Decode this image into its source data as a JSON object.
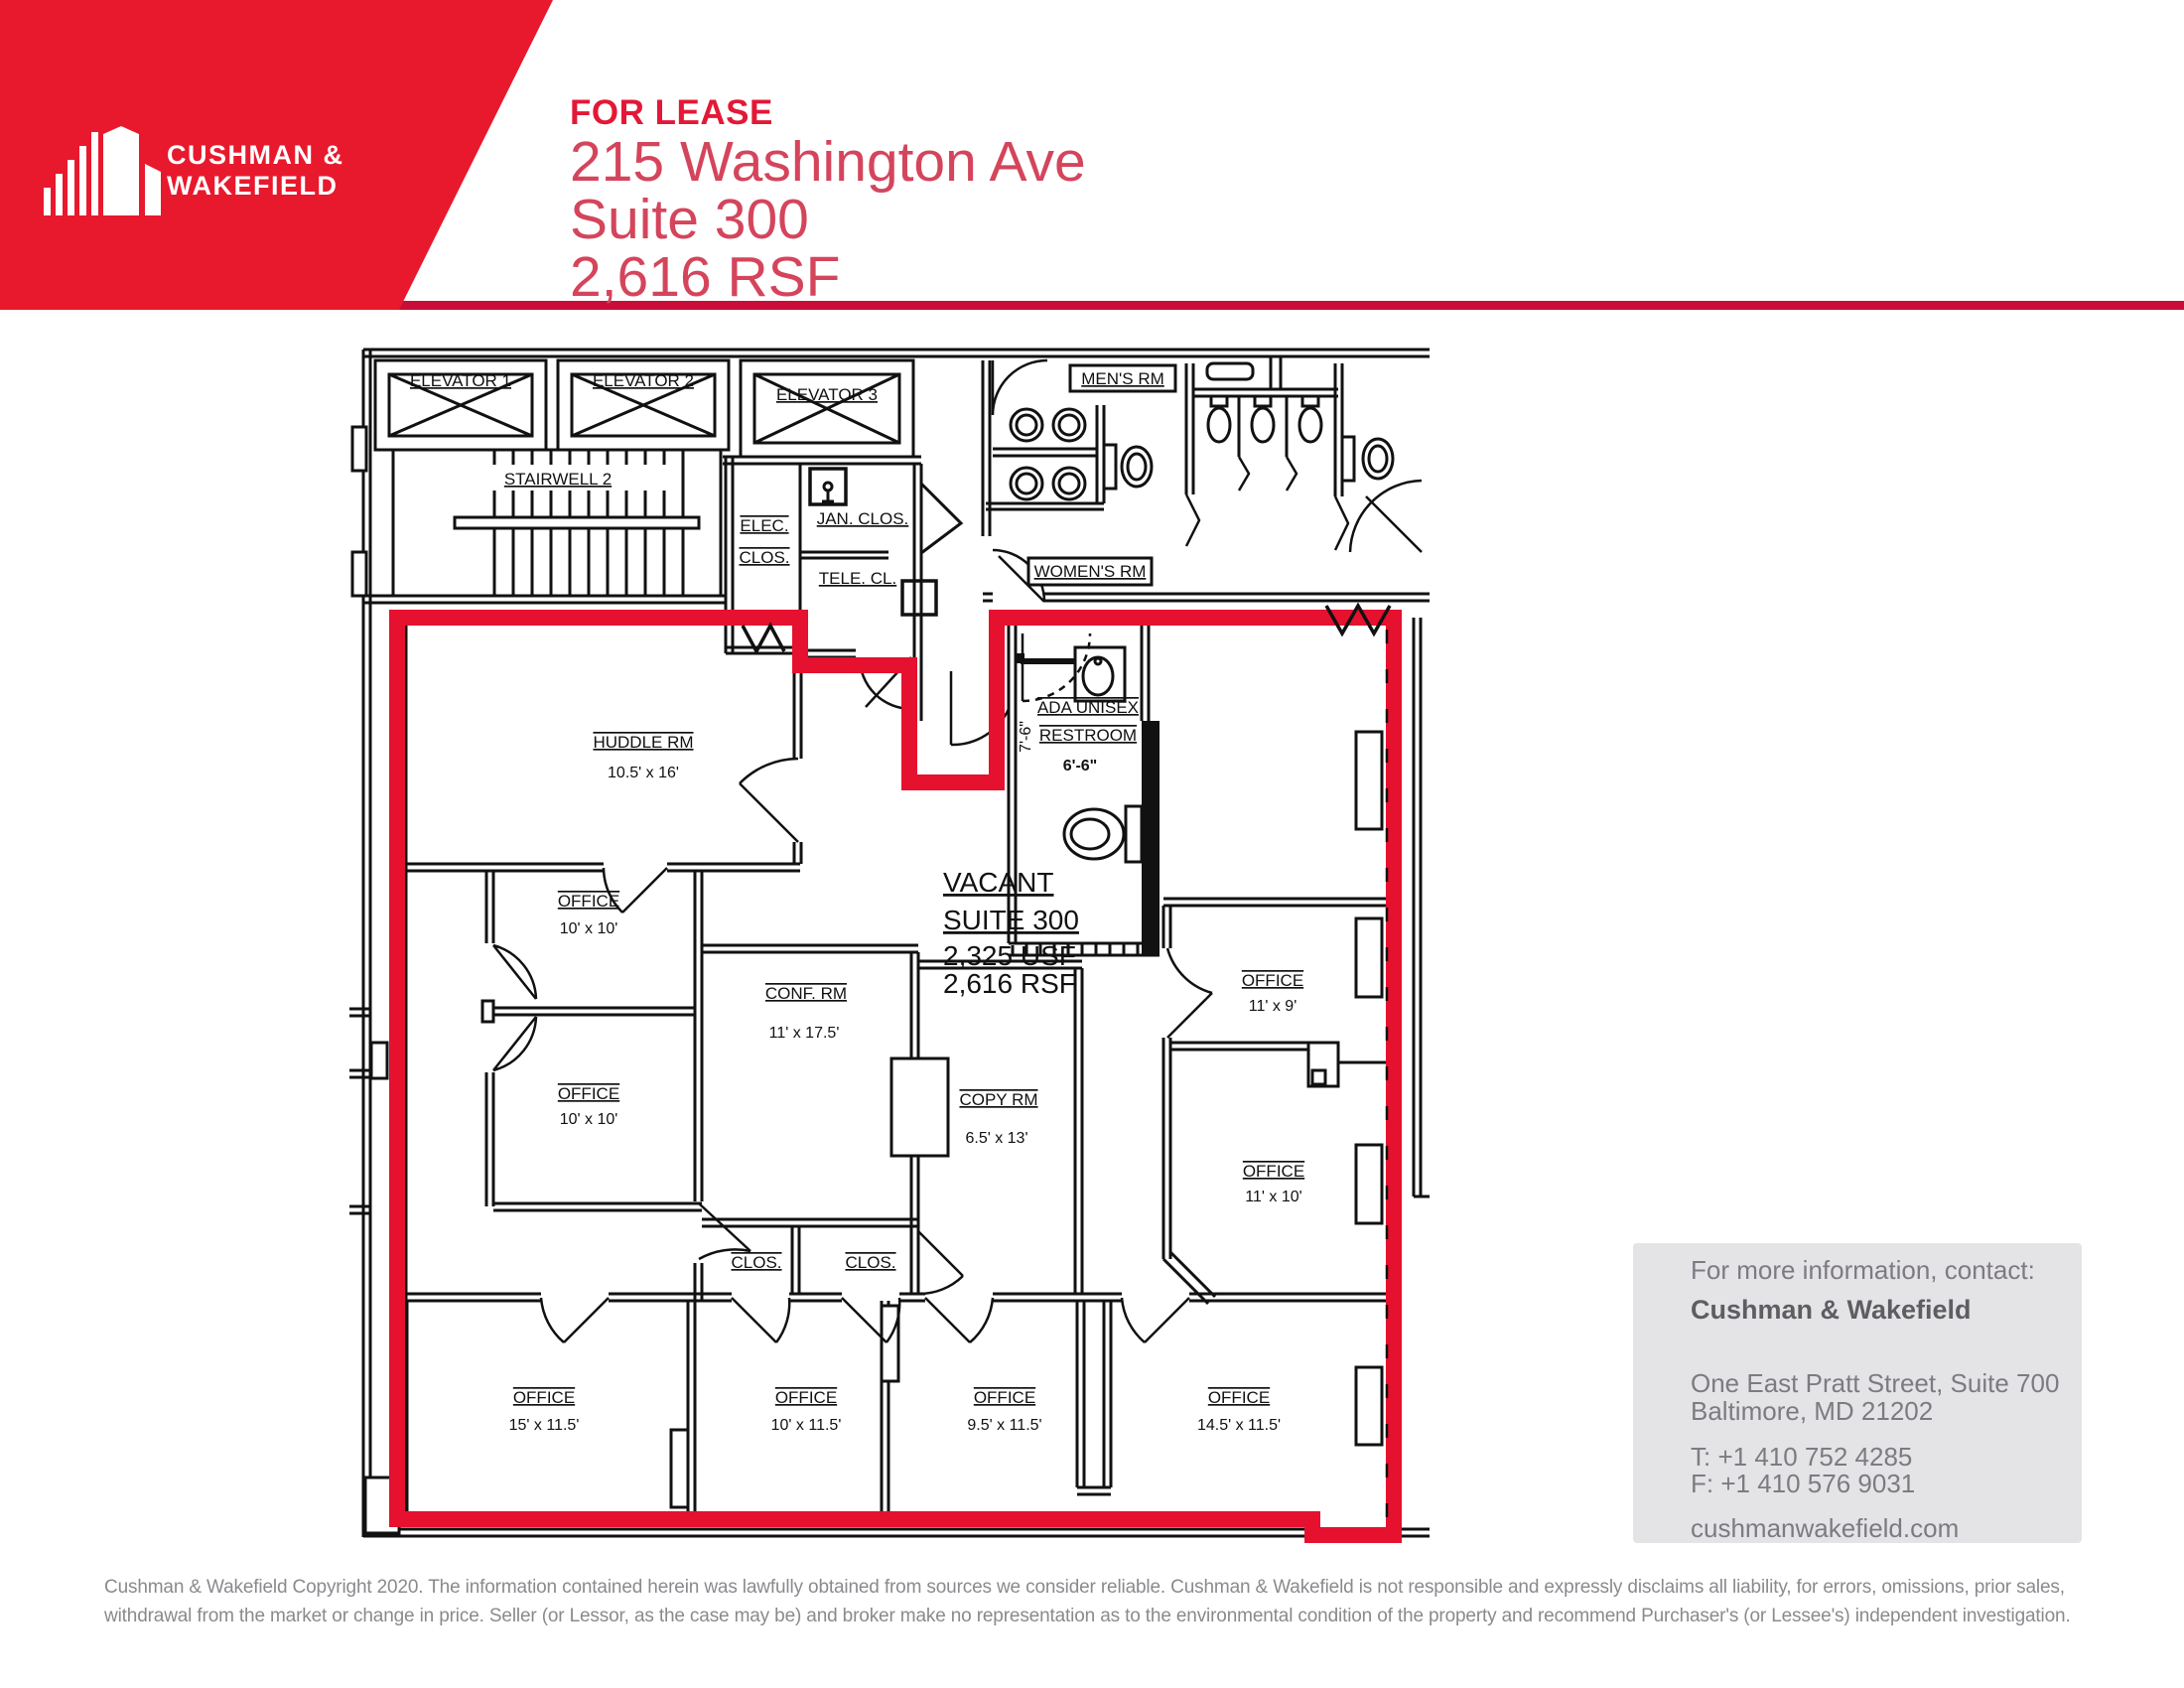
{
  "colors": {
    "banner_red": "#E8192D",
    "rule_red": "#C70D38",
    "for_lease_red": "#E31837",
    "address_red": "#D4455C",
    "suite_outline_red": "#E5112F",
    "plan_line": "#111111",
    "contact_bg": "#E4E3E6",
    "contact_text": "#7D7B81",
    "contact_bold": "#5E5D62",
    "disclaimer_text": "#8B898E"
  },
  "logo": {
    "line1": "CUSHMAN &",
    "line2": "WAKEFIELD"
  },
  "header": {
    "tag": "FOR LEASE",
    "address": "215 Washington Ave",
    "suite": "Suite 300",
    "size": "2,616 RSF"
  },
  "plan_labels": {
    "elevator1": "ELEVATOR 1",
    "elevator2": "ELEVATOR 2",
    "elevator3": "ELEVATOR 3",
    "stairwell": "STAIRWELL 2",
    "elec_l1": "ELEC.",
    "elec_l2": "CLOS.",
    "jan": "JAN. CLOS.",
    "tele": "TELE. CL.",
    "mens": "MEN'S RM",
    "womens": "WOMEN'S RM",
    "huddle_name": "HUDDLE RM",
    "huddle_dim": "10.5' x 16'",
    "ada_l1": "ADA UNISEX",
    "ada_l2": "RESTROOM",
    "ada_w": "6'-6\"",
    "ada_h": "7'-6\"",
    "vacant_l1": "VACANT",
    "vacant_l2": "SUITE 300",
    "vacant_l3": "2,325 USF",
    "vacant_l4": "2,616 RSF",
    "office": "OFFICE",
    "office1_dim": "10' x 10'",
    "office2_dim": "10' x 10'",
    "conf_name": "CONF. RM",
    "conf_dim": "11' x 17.5'",
    "copy_name": "COPY RM",
    "copy_dim": "6.5' x 13'",
    "clos1": "CLOS.",
    "clos2": "CLOS.",
    "office_11x9_dim": "11' x 9'",
    "office_11x10_dim": "11' x 10'",
    "office_15_dim": "15' x 11.5'",
    "office_10_dim": "10' x 11.5'",
    "office_95_dim": "9.5' x 11.5'",
    "office_145_dim": "14.5' x 11.5'"
  },
  "contact": {
    "intro": "For more information, contact:",
    "name": "Cushman & Wakefield",
    "address1": "One East Pratt Street, Suite 700",
    "address2": "Baltimore, MD 21202",
    "phone": "T: +1 410 752 4285",
    "fax": "F: +1 410 576 9031",
    "website": "cushmanwakefield.com"
  },
  "disclaimer": {
    "line1": "Cushman & Wakefield Copyright 2020. The information contained herein was lawfully obtained from sources we consider reliable. Cushman & Wakefield is not responsible and expressly disclaims all liability, for errors, omissions, prior sales,",
    "line2": "withdrawal from the market or change in price. Seller (or Lessor, as the case may be) and broker make no representation as to the environmental condition of the property and recommend Purchaser's (or Lessee's) independent investigation."
  }
}
